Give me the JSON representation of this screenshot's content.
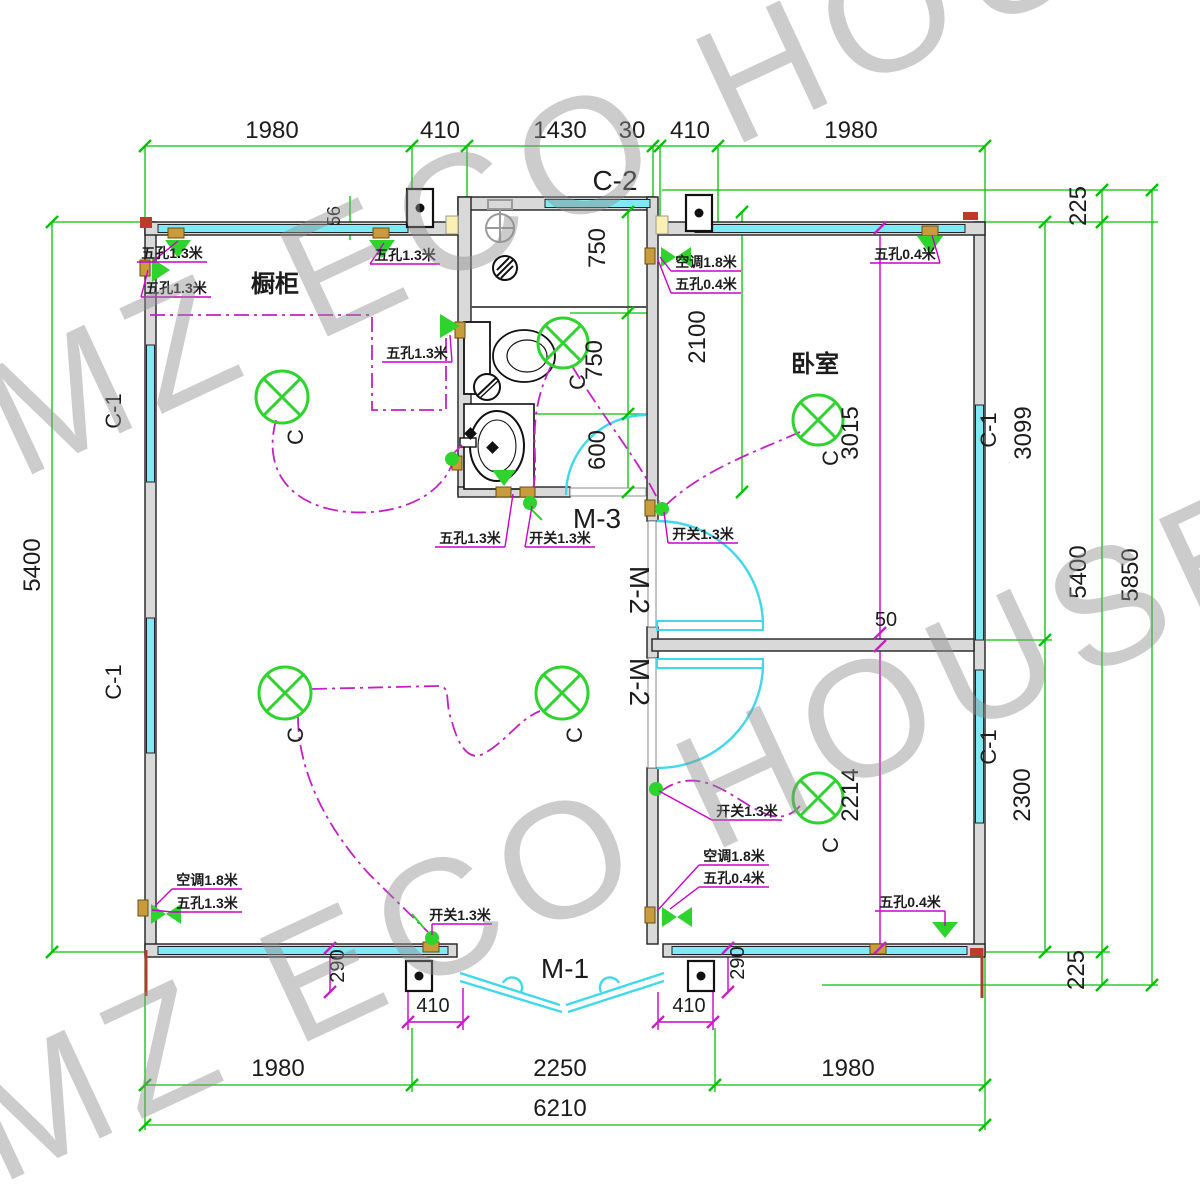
{
  "watermark": {
    "text": "MZ ECO HOUSE"
  },
  "rooms": {
    "cabinet": "橱柜",
    "bedroom": "卧室"
  },
  "openings": {
    "c1": "C-1",
    "c2": "C-2",
    "m1": "M-1",
    "m2": "M-2",
    "m3": "M-3"
  },
  "symbols": {
    "light": "C"
  },
  "annotations": {
    "socket_13": "五孔1.3米",
    "socket_04": "五孔0.4米",
    "switch_13": "开关1.3米",
    "ac_18": "空调1.8米"
  },
  "dimensions": {
    "top_row": [
      "1980",
      "410",
      "1430",
      "30",
      "410",
      "1980"
    ],
    "bottom_row": [
      "1980",
      "2250",
      "1980"
    ],
    "total_width": "6210",
    "left_height": "5400",
    "right": {
      "offset_top": "225",
      "window_upper": "3099",
      "inner_height": "5400",
      "outer_height": "5850",
      "window_lower": "2300",
      "offset_bottom": "225"
    },
    "bathroom": [
      "750",
      "750",
      "600"
    ],
    "bathroom_height": "2100",
    "bedroom_depth": "3015",
    "lower_room_depth": "2214",
    "wall_gap": "50",
    "panel_offset": "56",
    "door_side": "410",
    "door_jamb": "290"
  },
  "colors": {
    "dimension_green": "#00c300",
    "wiring_magenta": "#c520c5",
    "window_cyan": "#7eeaf5",
    "light_green": "#2ed32e",
    "wall_gray": "#d9d9d9",
    "corner_red": "#c0392b"
  }
}
